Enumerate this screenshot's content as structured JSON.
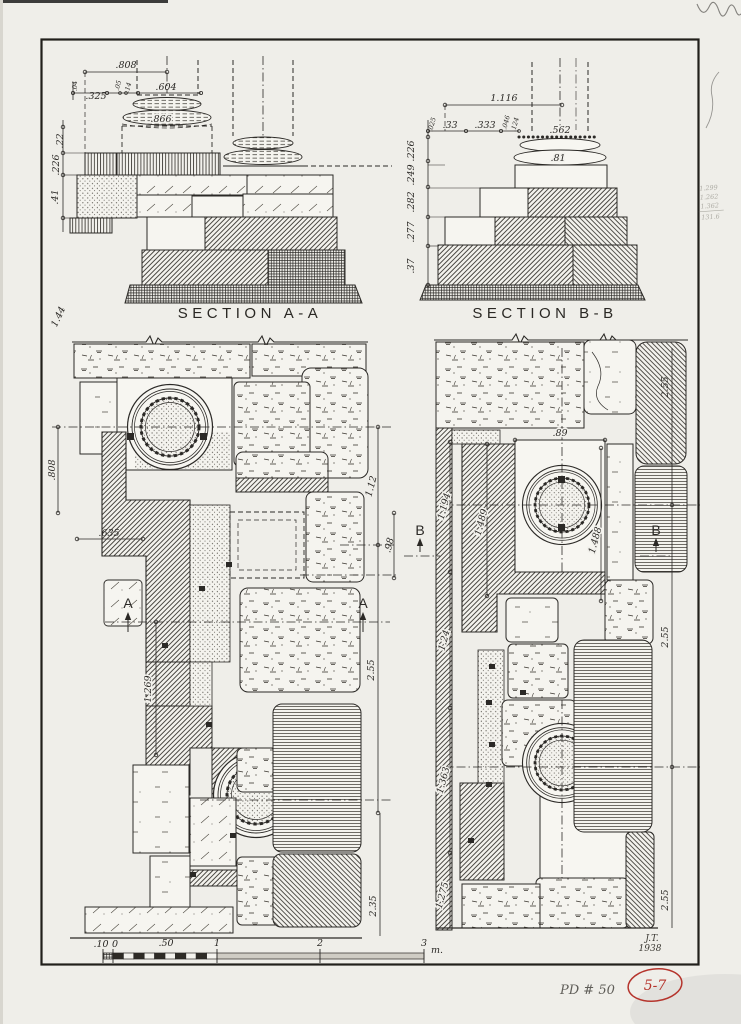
{
  "colors": {
    "ink": "#2b2926",
    "paper": "#efeee9",
    "stamp_red": "#b5342c",
    "pencil": "#6b6b6b"
  },
  "section_a": {
    "title": "SECTION A-A",
    "dims": {
      "w808": ".808",
      "w325": ".325",
      "t04": ".04",
      "t05": ".05",
      "t14": ".14",
      "w604": ".604",
      "w866": ".866",
      "h22": ".22",
      "h226": ".226",
      "h41": ".41"
    }
  },
  "section_b": {
    "title": "SECTION B-B",
    "dims": {
      "w1116": "1.116",
      "t025": ".025",
      "w33": ".33",
      "w333": ".333",
      "t046": ".046",
      "t124": ".124",
      "w562": ".562",
      "w81": ".81",
      "h": [
        ".226",
        ".249",
        ".282",
        ".277",
        ".37"
      ]
    }
  },
  "plan_left": {
    "marker": "A",
    "dims": {
      "d144": "1.44",
      "d808": ".808",
      "d635": ".635",
      "d1269": "1.269",
      "d112": "1.12",
      "d98": ".98",
      "d255": "2.55",
      "d235": "2.35"
    }
  },
  "plan_right": {
    "marker": "B",
    "dims": {
      "d89": ".89",
      "chain": [
        "1.194",
        "1.24",
        "1.363",
        "1.275"
      ],
      "d1489": "1.489",
      "d1488": "1.488",
      "right": [
        "2.55",
        "2.55",
        "2.55"
      ]
    }
  },
  "scale_bar": {
    "ticks": [
      ".10",
      "0",
      ".50",
      "1",
      "2",
      "3"
    ],
    "unit": "m."
  },
  "signature": {
    "initials": "J.T.",
    "year": "1938"
  },
  "annotations": {
    "pd_number": "PD # 50",
    "plate_ref": "5-7",
    "margin_notes": [
      "1.299",
      "1.262",
      "1.362",
      "131.6"
    ]
  }
}
